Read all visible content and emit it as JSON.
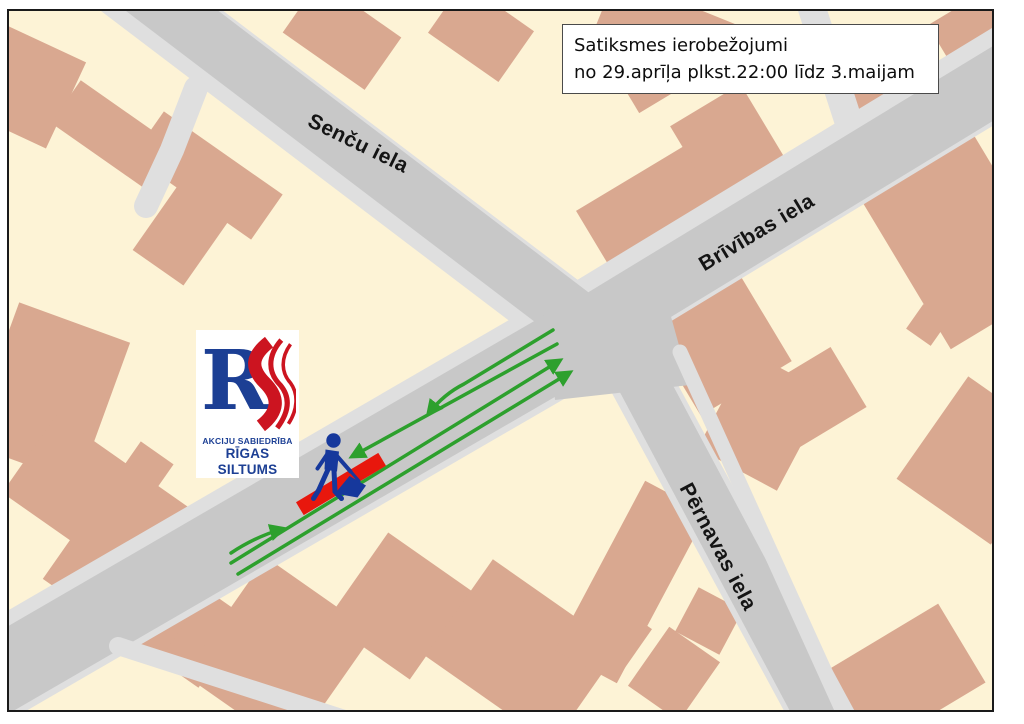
{
  "notice": {
    "line1": "Satiksmes ierobežojumi",
    "line2": "no 29.aprīļa plkst.22:00 līdz 3.maijam"
  },
  "streets": {
    "senchu": "Senču iela",
    "brivibas": "Brīvības iela",
    "pernavas": "Pērnavas iela"
  },
  "logo": {
    "monogram_r": "R",
    "company_type": "AKCIJU SABIEDRĪBA",
    "company_name": "RĪGAS SILTUMS"
  },
  "colors": {
    "background": "#fdf3d6",
    "building": "#d9a890",
    "road": "#c8c8c8",
    "sidewalk": "#dfdfdf",
    "arrow": "#2da02d",
    "closure": "#e8170d",
    "worker": "#16389c",
    "logo_blue": "#1c3f94",
    "logo_red": "#cc1420",
    "frame": "#1a1a1a"
  }
}
